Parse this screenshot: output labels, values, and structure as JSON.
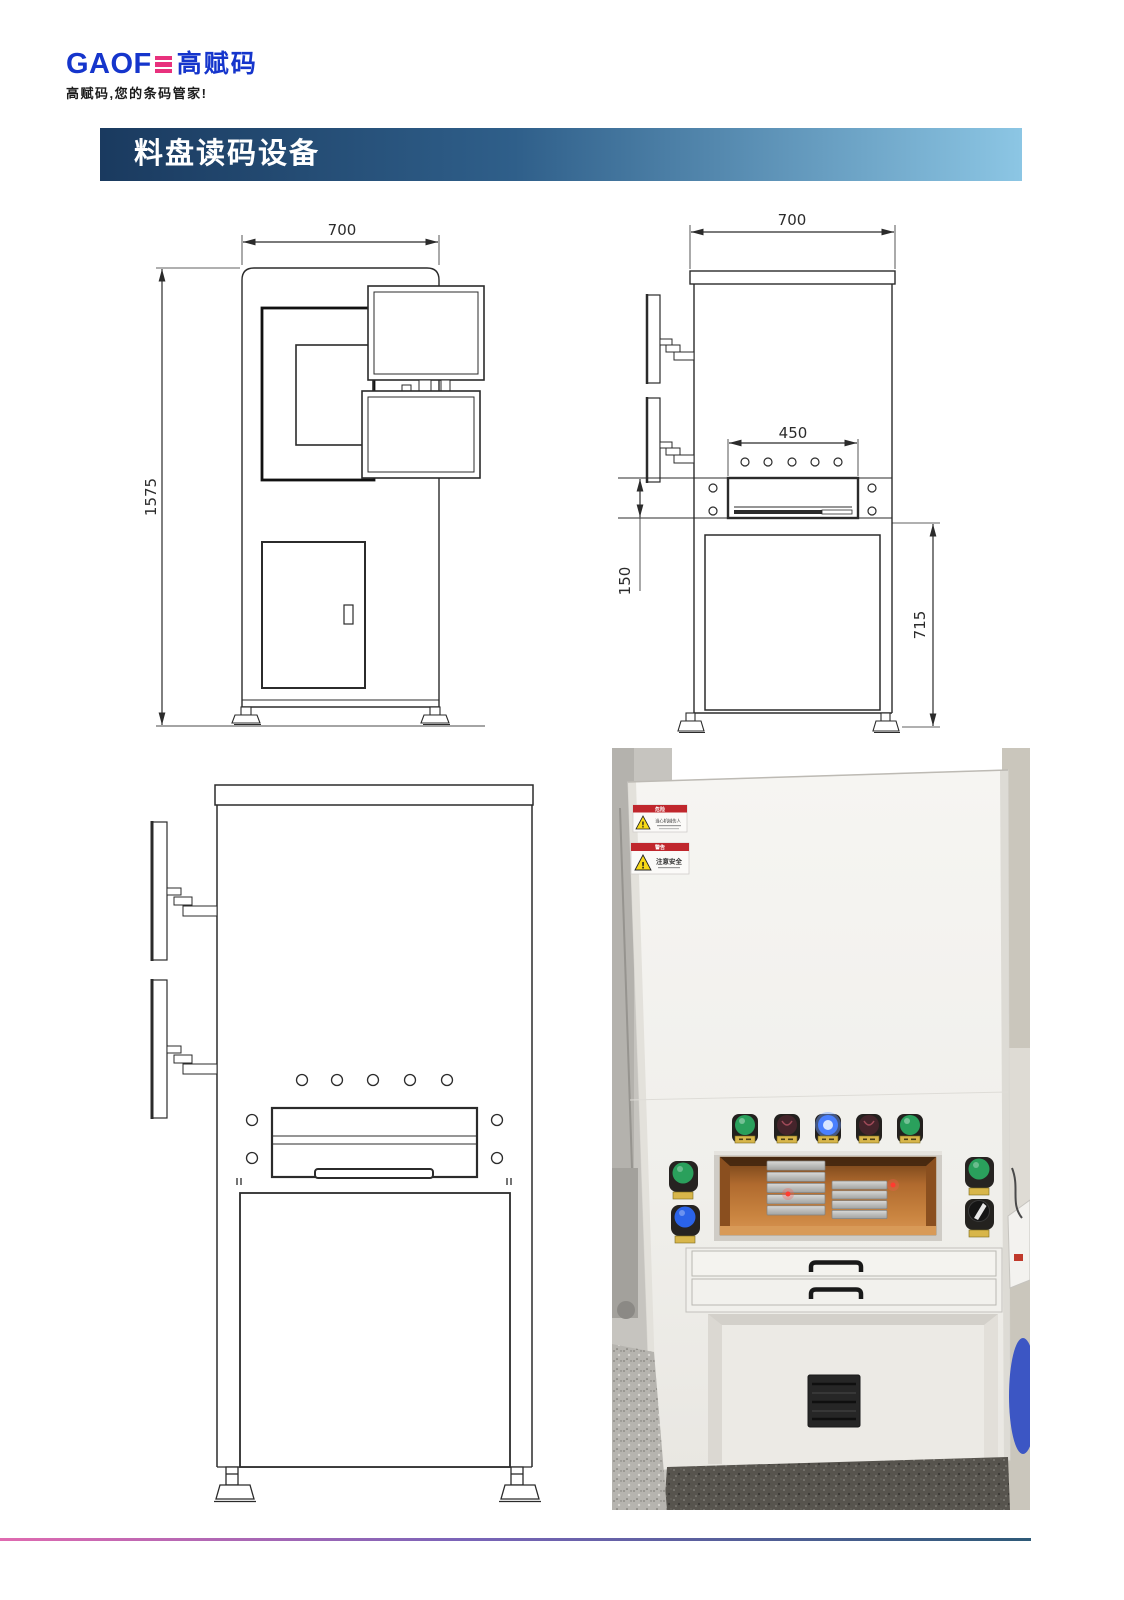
{
  "brand": {
    "latin": "GAOF",
    "cn": "高赋码",
    "tagline": "高赋码,您的条码管家!",
    "blue": "#1535cc",
    "pink": "#e8317d"
  },
  "header": {
    "title": "料盘读码设备",
    "gradient_left": "#1a3a5f",
    "gradient_mid": "#2f5f8a",
    "gradient_right": "#8cc6e4"
  },
  "drawings": {
    "front_view": {
      "width_mm": "700",
      "height_mm": "1575"
    },
    "side_view": {
      "width_mm": "700",
      "tray_width_mm": "450",
      "tray_slot_height_mm": "150",
      "table_height_mm": "715"
    }
  },
  "photo": {
    "warning_labels": [
      {
        "header": "危险",
        "text": "当心机械伤人"
      },
      {
        "header": "警告",
        "text": "注意安全"
      }
    ],
    "indicator_buttons": [
      {
        "label": "green",
        "color": "#2aa05c"
      },
      {
        "label": "dark-red",
        "color": "#45242b"
      },
      {
        "label": "blue-lit",
        "color": "#4a80ff"
      },
      {
        "label": "dark-red",
        "color": "#45242b"
      },
      {
        "label": "green",
        "color": "#2aa05c"
      }
    ],
    "side_buttons": [
      {
        "position": "left-top",
        "color": "#2aa05c"
      },
      {
        "position": "left-bottom",
        "color": "#2b63e8"
      },
      {
        "position": "right-top",
        "color": "#2aa05c"
      },
      {
        "position": "right-bottom",
        "color": "#151515"
      }
    ],
    "window_interior_color": "#b06a2e"
  },
  "footer": {
    "gradient_left": "#e06ab0",
    "gradient_mid": "#7a64b8",
    "gradient_right": "#2e5a78"
  }
}
